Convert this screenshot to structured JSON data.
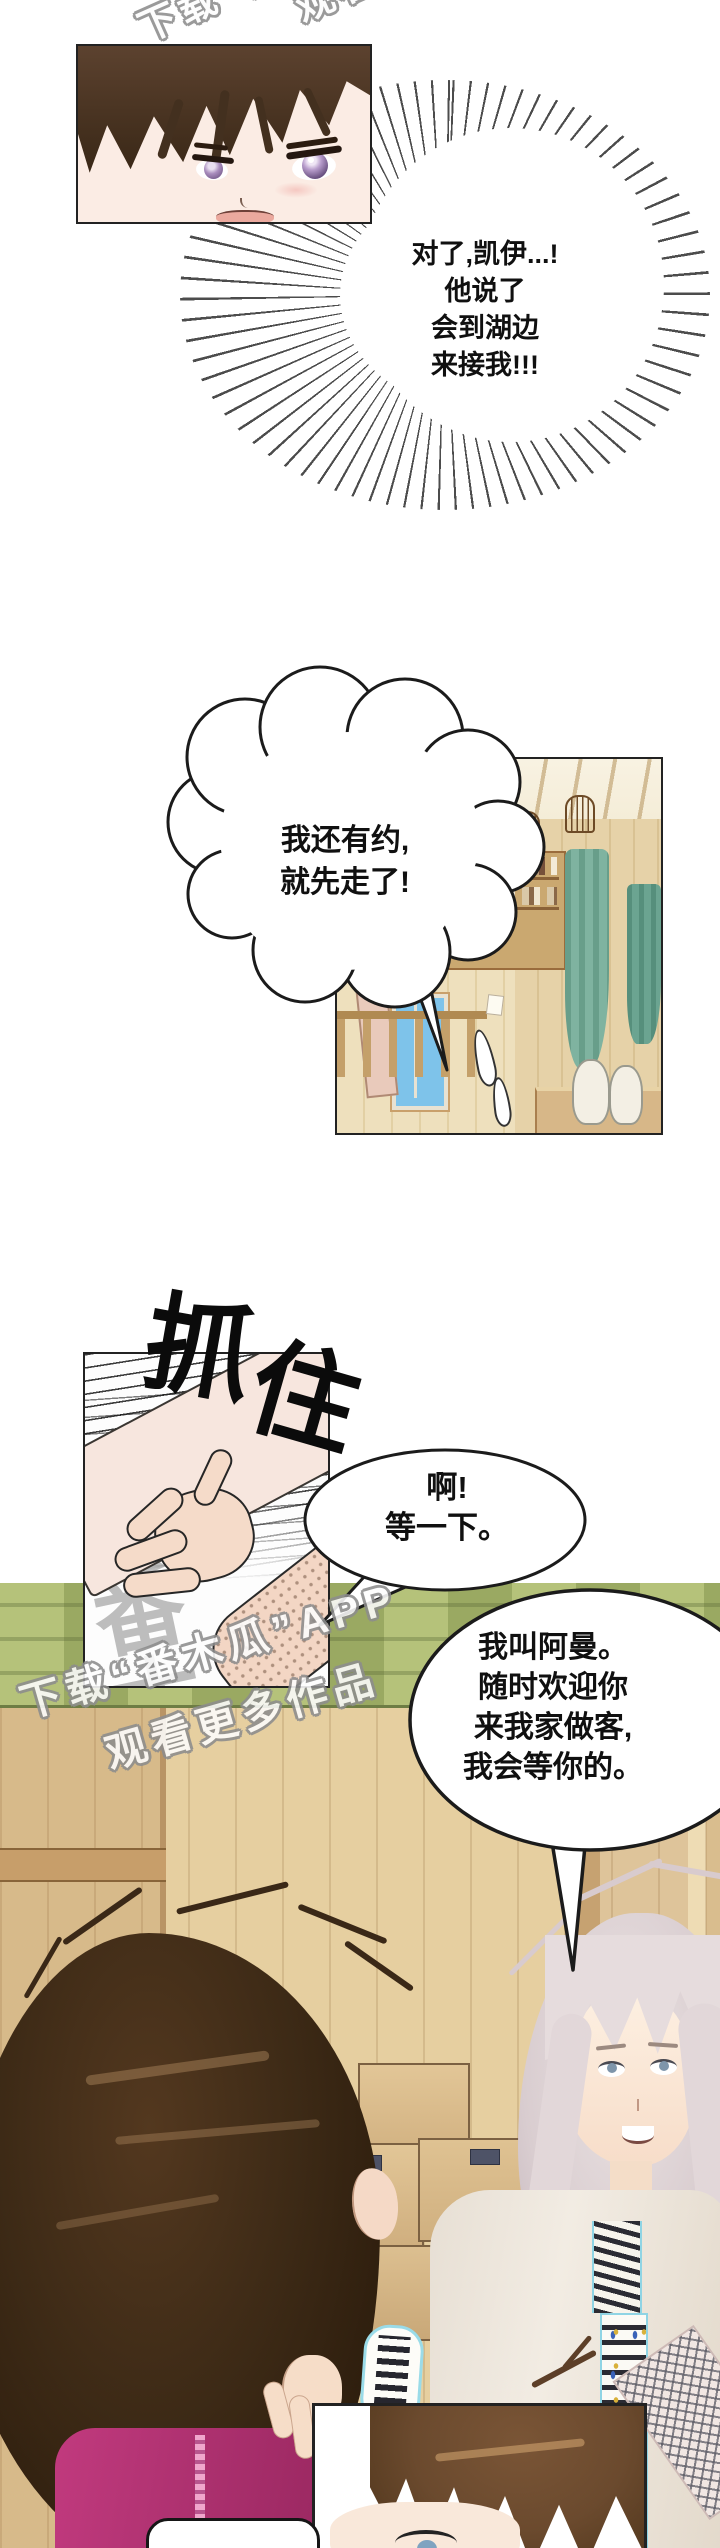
{
  "page": {
    "width": 720,
    "height": 2548,
    "background": "#ffffff",
    "type": "comic-page"
  },
  "watermark": {
    "line1": "下载“番木瓜”APP",
    "line2": "观看更多作品"
  },
  "sfx": {
    "grab_chars": [
      "抓",
      "住"
    ],
    "halftone": "番木"
  },
  "bubbles": {
    "burst": {
      "lines": [
        "对了,凯伊...!",
        "他说了",
        "会到湖边",
        "来接我!!!"
      ]
    },
    "cloud": {
      "lines": [
        "我还有约,",
        "就先走了!"
      ]
    },
    "shout": {
      "lines": [
        "啊!",
        "等一下。"
      ]
    },
    "intro": {
      "lines": [
        "我叫阿曼。",
        "随时欢迎你",
        "来我家做客,",
        "我会等你的。"
      ]
    }
  },
  "colors": {
    "ink": "#1b1b1b",
    "skin": "#f6e0d0",
    "hair_dark_brown": "#3d2a16",
    "eye_violet": "#a98dbd",
    "eye_blue": "#7e95aa",
    "hair_platinum": "#ded4d6",
    "shirt_cream": "#eee8df",
    "collar_cyan": "#8fd4e4",
    "magenta_top": "#b03273",
    "wood_light": "#e6cfa0",
    "wood_dark": "#b99465",
    "curtain_teal": "#7fb3a0",
    "sky_blue": "#7ec3ea",
    "grass_light": "#b5c27a",
    "grass_dark": "#9aa962",
    "watermark_grey": "#8d8d8d"
  }
}
